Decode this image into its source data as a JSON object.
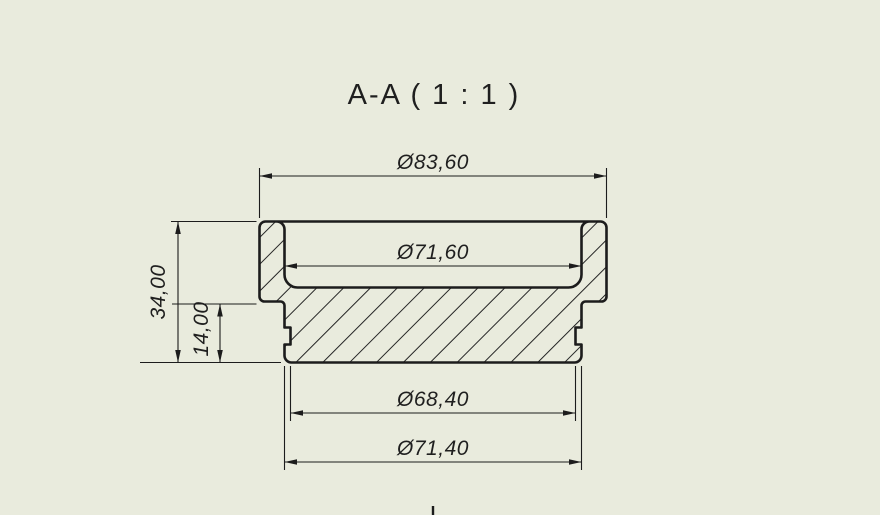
{
  "view": {
    "title": "A-A ( 1 : 1 )"
  },
  "dimensions": {
    "outer_diameter": {
      "label": "Ø83,60"
    },
    "cavity_diameter": {
      "label": "Ø71,60"
    },
    "total_height": {
      "label": "34,00"
    },
    "lower_height": {
      "label": "14,00"
    },
    "groove_diameter": {
      "label": "Ø68,40"
    },
    "body_diameter": {
      "label": "Ø71,40"
    }
  },
  "colors": {
    "background": "#e9ebdd",
    "line": "#1c1c1c",
    "text": "#1f1f1f"
  }
}
